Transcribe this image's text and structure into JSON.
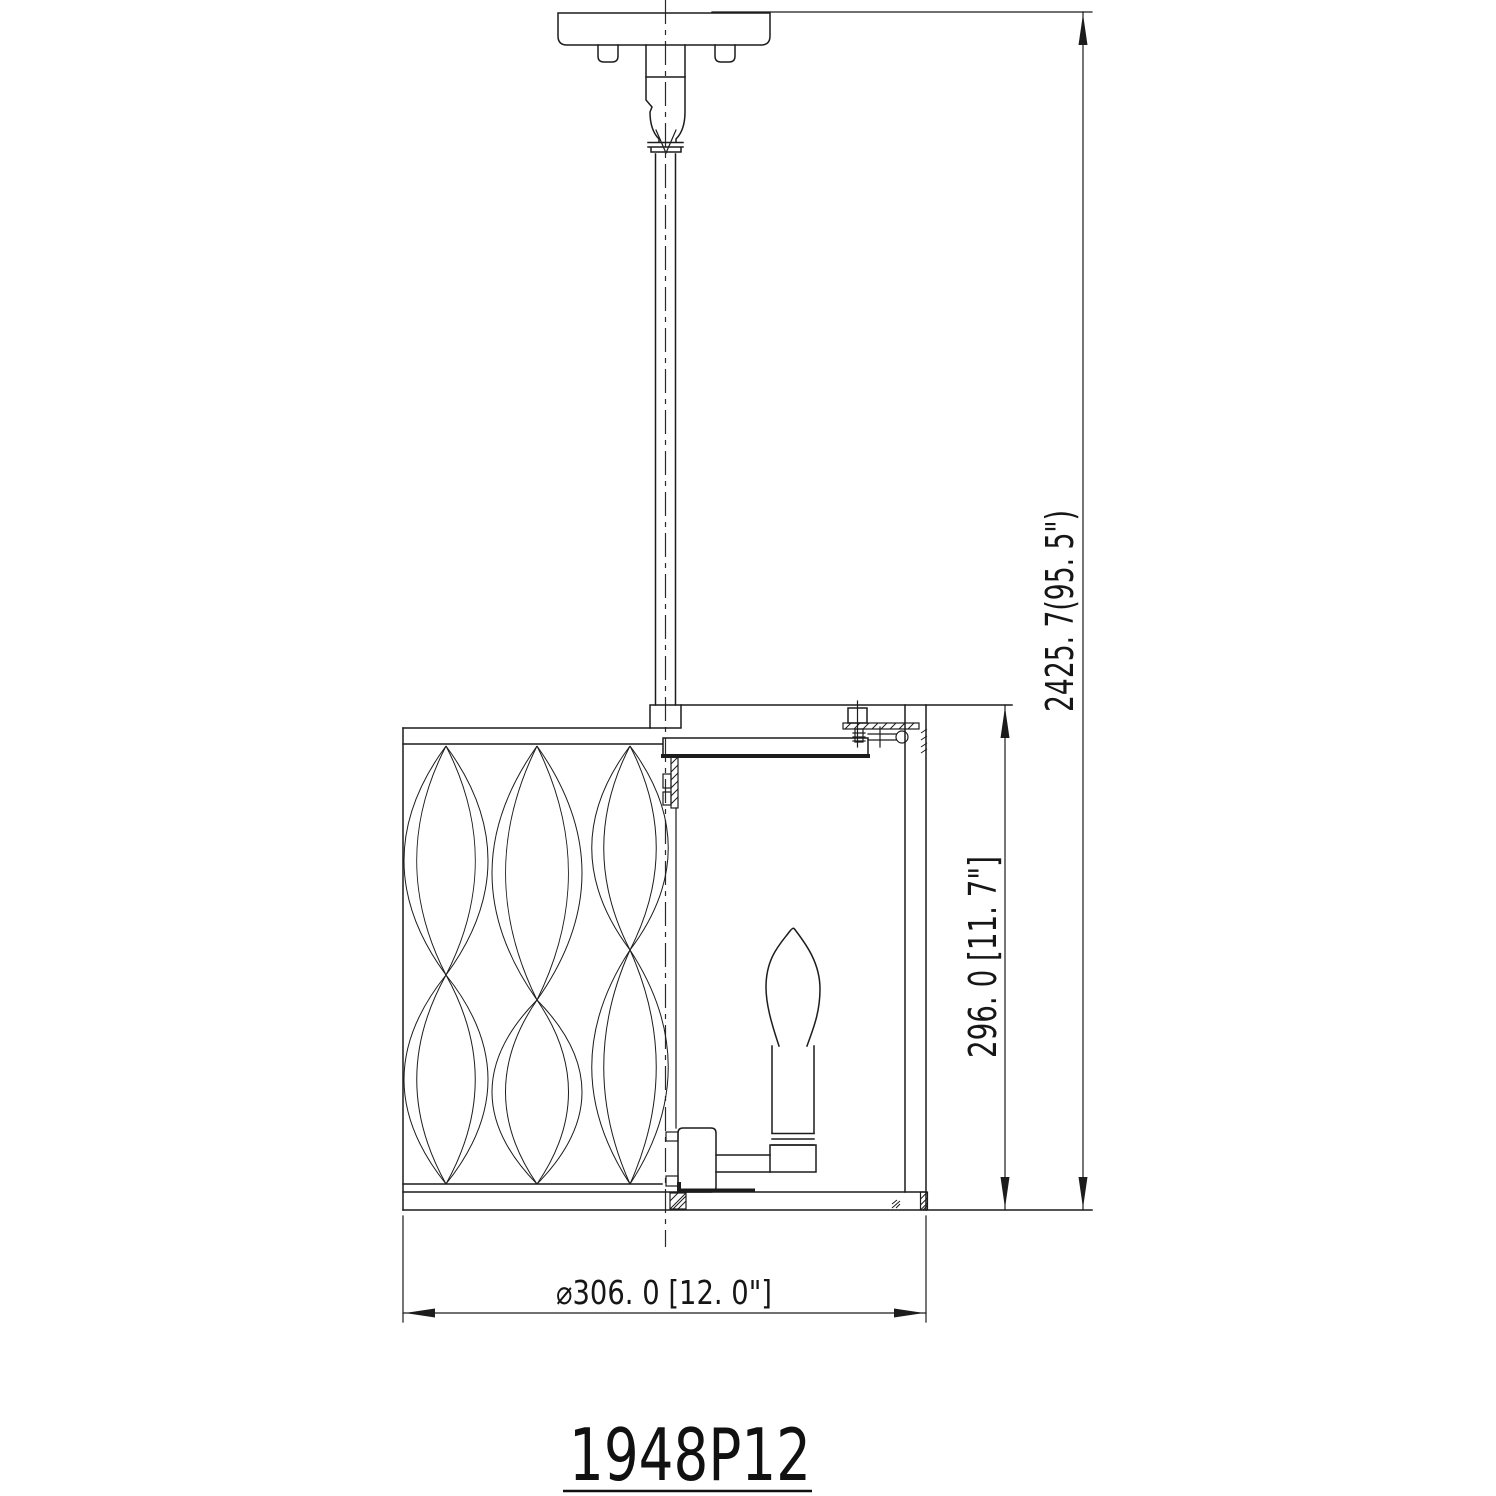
{
  "drawing": {
    "model_number": "1948P12",
    "dimensions": {
      "overall_height": {
        "label": "2425. 7(95. 5\")",
        "mm": 2425.7,
        "inches": 95.5
      },
      "body_height": {
        "label": "296. 0 [11. 7\"]",
        "mm": 296.0,
        "inches": 11.7
      },
      "diameter": {
        "label": "⌀306. 0 [12. 0\"]",
        "mm": 306.0,
        "inches": 12.0
      }
    },
    "line_color": "#1c1c1c",
    "background_color": "#ffffff"
  }
}
